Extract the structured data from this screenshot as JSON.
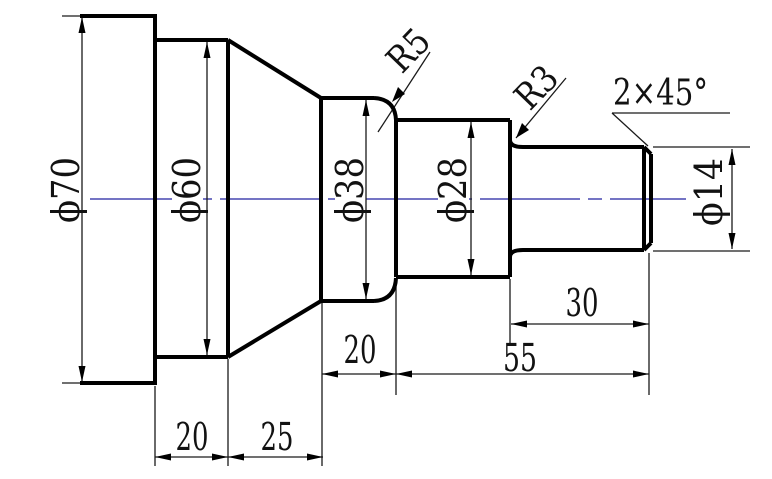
{
  "drawing": {
    "diameter_dimensions": {
      "phi70": "ϕ70",
      "phi60": "ϕ60",
      "phi38": "ϕ38",
      "phi28": "ϕ28",
      "phi14": "ϕ14"
    },
    "radius_dimensions": {
      "r5": "R5",
      "r3": "R3"
    },
    "chamfer_note": "2×45°",
    "length_dimensions": {
      "flange_to_taper": "20",
      "taper": "25",
      "phi38_section": "20",
      "phi14_section": "30",
      "right_sections_total": "55"
    },
    "colors": {
      "outline": "#000000",
      "centerline": "#2222a0",
      "dimension_lines": "#1a1a1a",
      "background": "#ffffff"
    }
  }
}
